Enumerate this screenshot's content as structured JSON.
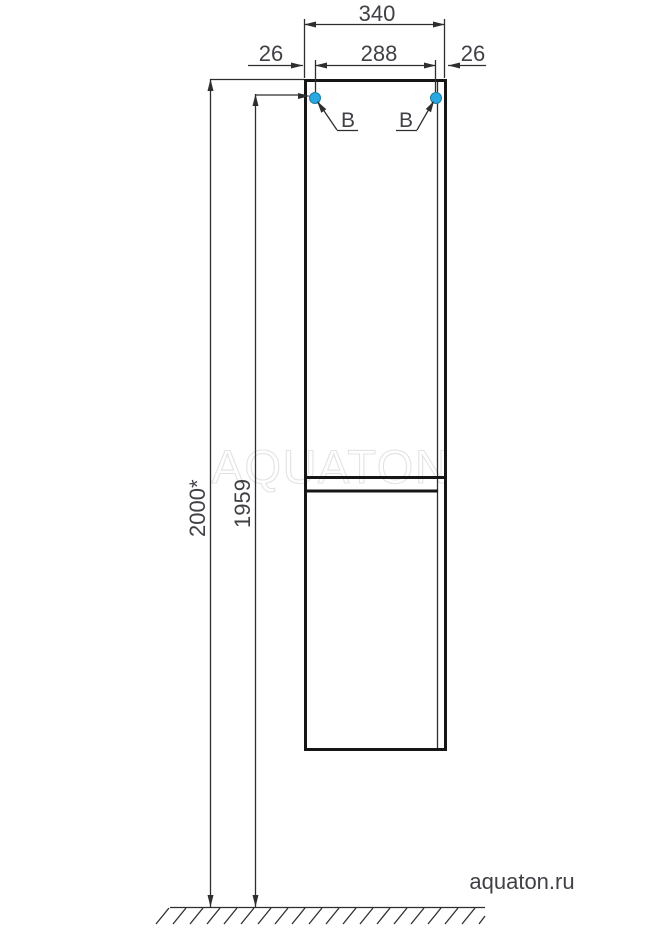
{
  "dimensions": {
    "overall_width": "340",
    "hinge_span": "288",
    "left_inset": "26",
    "right_inset": "26",
    "overall_height": "2000*",
    "hinge_height": "1959"
  },
  "callouts": {
    "left": "B",
    "right": "B"
  },
  "watermarks": {
    "center": "AQUATON",
    "site": "aquaton.ru"
  },
  "colors": {
    "hinge_marker_fill": "#2aa8df",
    "hinge_marker_stroke": "#1a7ca8",
    "line": "#2e2e2e",
    "watermark_outline": "#e3e3e3",
    "watermark_site": "#d2d2d2"
  }
}
